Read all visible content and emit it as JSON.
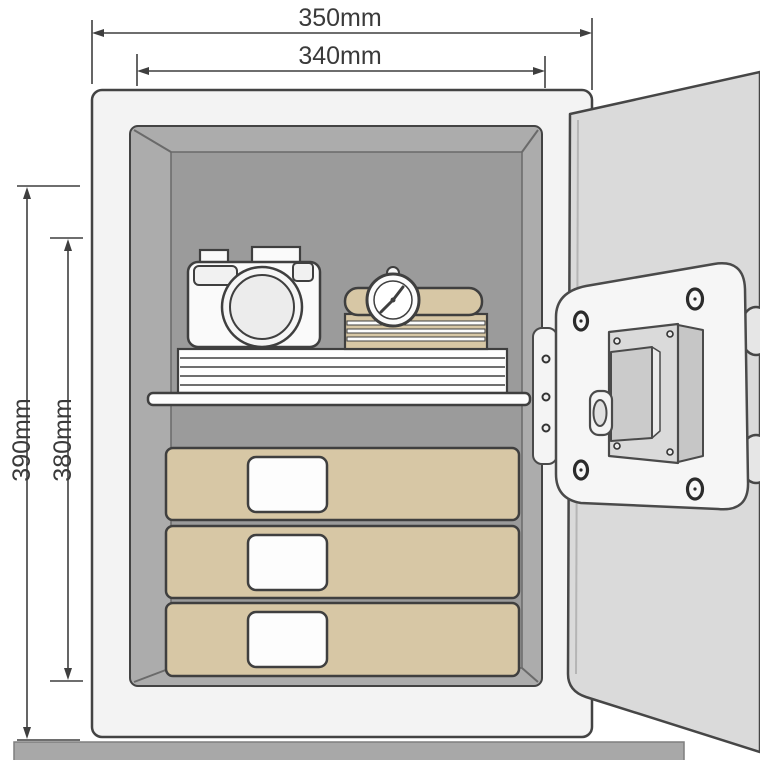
{
  "title": "Safe internal dimensions diagram",
  "dimensions": {
    "top_outer": "350mm",
    "top_inner": "340mm",
    "left_outer": "390mm",
    "left_inner": "380mm"
  },
  "objects": [
    "safe-body",
    "safe-interior",
    "shelf",
    "document-stack",
    "camera",
    "wristwatch",
    "book-stack",
    "storage-box-1",
    "storage-box-2",
    "storage-box-3",
    "safe-door",
    "hinge-strip",
    "lock-plate",
    "keypad-module",
    "lock-handle",
    "lock-bolt-upper",
    "lock-bolt-lower",
    "floor-bar"
  ],
  "colors": {
    "outline": "#434343",
    "body_fill": "#f3f3f3",
    "interior_wall": "#acacac",
    "interior_back": "#9b9b9b",
    "tan": "#d7c7a5",
    "door_fill": "#dadada",
    "plate_fill": "#f6f6f6",
    "keypad_fill": "#dadada",
    "floor_bar": "#a8a8a8",
    "dimension_text": "#3a3a3a"
  }
}
